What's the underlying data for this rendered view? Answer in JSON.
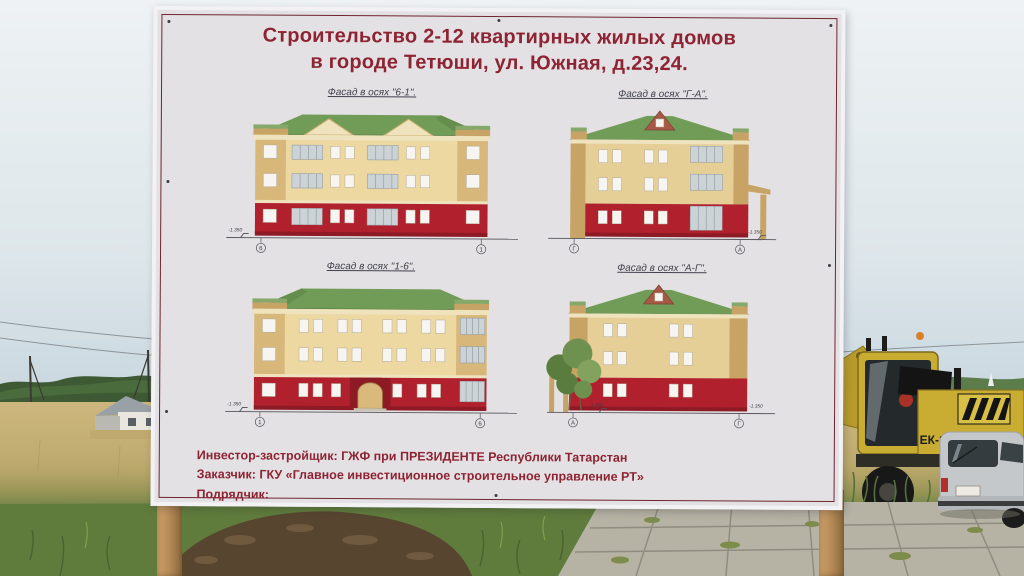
{
  "billboard": {
    "title_line1": "Строительство 2-12 квартирных жилых домов",
    "title_line2": "в городе Тетюши, ул. Южная, д.23,24.",
    "facades": [
      {
        "label": "Фасад в осях \"6-1\".",
        "axis_left": "6",
        "axis_right": "1",
        "elevation_mark": "-1.350"
      },
      {
        "label": "Фасад в осях \"Г-А\".",
        "axis_left": "Г",
        "axis_right": "А",
        "elevation_mark": "-1.350"
      },
      {
        "label": "Фасад в осях \"1-6\".",
        "axis_left": "1",
        "axis_right": "6",
        "elevation_mark": "-1.350"
      },
      {
        "label": "Фасад в осях \"А-Г\".",
        "axis_left": "А",
        "axis_right": "Г",
        "elevation_mark": "-1.350"
      }
    ],
    "footer_lines": [
      "Инвестор-застройщик: ГЖФ при ПРЕЗИДЕНТЕ Республики Татарстан",
      "Заказчик: ГКУ «Главное инвестиционное строительное управление РТ»",
      "Подрядчик:"
    ]
  },
  "background": {
    "crane_label": "ЕК-14"
  },
  "colors": {
    "sky-top": "#eef2f4",
    "sky-bottom": "#c7d5de",
    "board-bg": "#e3e1e4",
    "board-border": "#702531",
    "title-red": "#8e2433",
    "label-color": "#43434e",
    "wall-cream": "#ecd8a0",
    "wall-tan": "#d8b87a",
    "wall-red": "#b1202d",
    "roof-green": "#719c58",
    "roof-green-dark": "#5b8243",
    "gable-brown": "#a65a45",
    "glazing-gray": "#ccd3d7",
    "window-white": "#f6f5f1",
    "cornice-cream": "#efe3bd",
    "field-gold": "#c2aa70",
    "grass-green": "#5f7c3c",
    "treeline-green": "#3d5a35",
    "paving-gray": "#b6b2a4",
    "wood-post": "#b98d58",
    "crane-yellow": "#c9ad33",
    "car-silver": "#c5c8ca",
    "dirt-brown": "#57452f"
  }
}
